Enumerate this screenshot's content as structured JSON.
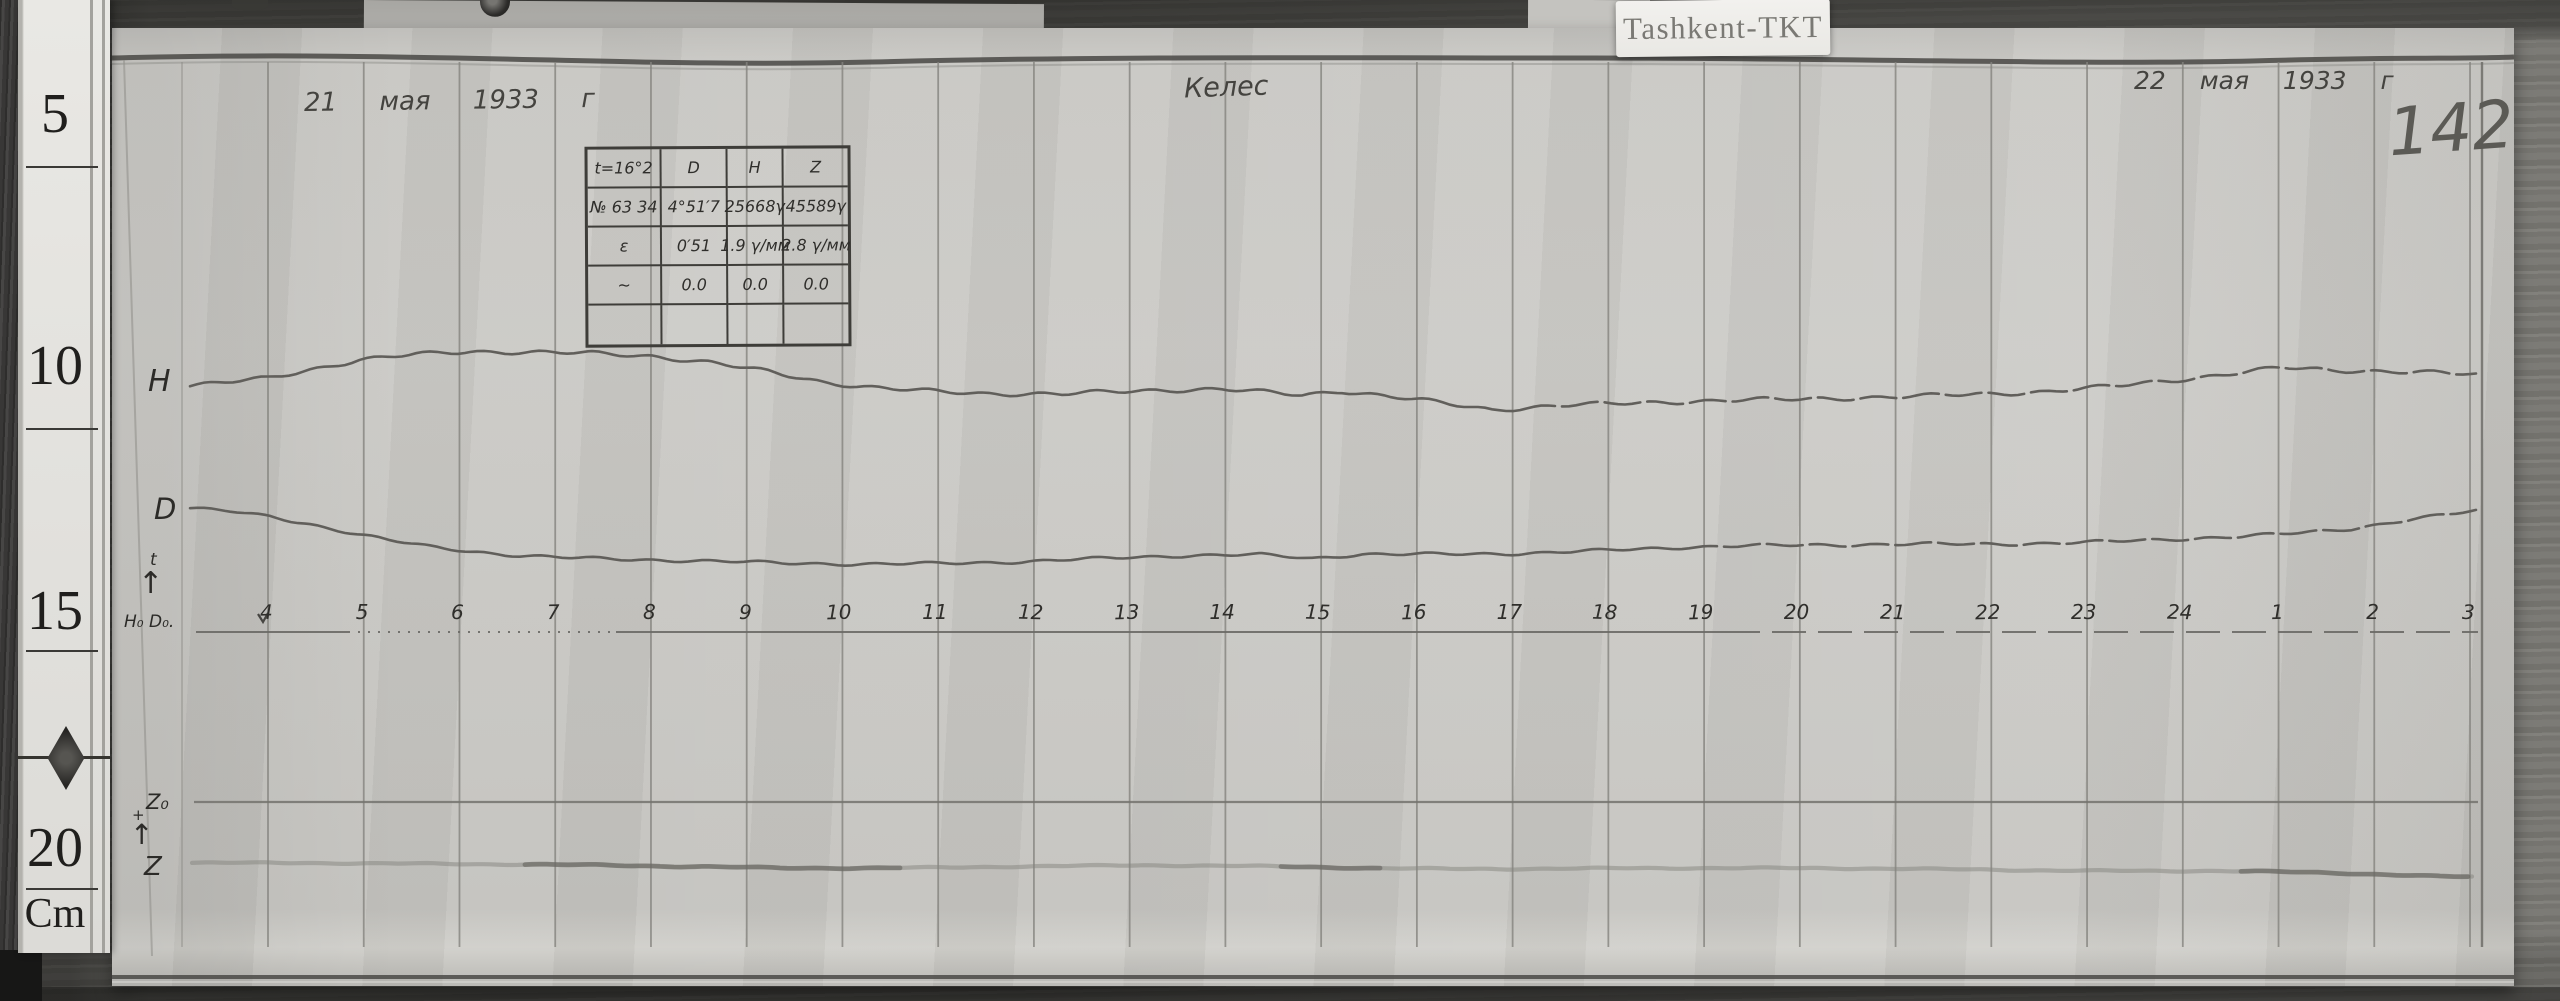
{
  "photo": {
    "label_tag": "Tashkent-TKT",
    "sheet_number": "142",
    "date_left": "21 мая 1933 г",
    "date_right": "22 мая 1933 г",
    "station_name": "Келес"
  },
  "ruler": {
    "marks": [
      "5",
      "10",
      "15",
      "20"
    ],
    "unit": "Cm"
  },
  "annotations": {
    "h_label": "H",
    "d_label": "D",
    "z_label": "Z",
    "z0_label": "Z₀",
    "h0d0_label": "H₀ D₀.",
    "t_label": "t",
    "arrow_up": "↑",
    "plus": "+"
  },
  "scale_table": {
    "rows": [
      [
        "t=16°2",
        "D",
        "H",
        "Z"
      ],
      [
        "№ 63 34",
        "4°51′7",
        "25668γ",
        "45589γ"
      ],
      [
        "ε",
        "0′51",
        "1.9 γ/мм",
        "2.8 γ/мм"
      ],
      [
        "~",
        "0.0",
        "0.0",
        "0.0"
      ],
      [
        "",
        "",
        "",
        ""
      ]
    ]
  },
  "chart_data": {
    "type": "line",
    "title": "Magnetogram, Keles (Tashkent-TKT), 21–22 May 1933, sheet 142",
    "axis_note": "hour lines 4h–24h then 1h–3h; y values are trace positions on the photographic paper in image pixels (down = larger); no printed numeric scale",
    "x_hours": [
      "4",
      "5",
      "6",
      "7",
      "8",
      "9",
      "10",
      "11",
      "12",
      "13",
      "14",
      "15",
      "16",
      "17",
      "18",
      "19",
      "20",
      "21",
      "22",
      "23",
      "24",
      "1",
      "2",
      "3"
    ],
    "scale_values": {
      "D": "0′51 per mm",
      "H": "1.9 γ/мм",
      "Z": "2.8 γ/мм"
    },
    "layout": {
      "x0": 268,
      "dx": 95.74,
      "grid_top": 62,
      "grid_bottom": 947,
      "label_y": 600,
      "left_border_x": 182,
      "right_border_x": 2482
    },
    "baselines": {
      "time_axis": {
        "y": 632,
        "segments": [
          {
            "x1": 196,
            "x2": 348,
            "dash": ""
          },
          {
            "x1": 348,
            "x2": 616,
            "dash": "2 8"
          },
          {
            "x1": 616,
            "x2": 1726,
            "dash": ""
          },
          {
            "x1": 1726,
            "x2": 2478,
            "dash": "34 12"
          }
        ]
      },
      "z0": {
        "y": 802,
        "x1": 194,
        "x2": 2478
      }
    },
    "series": [
      {
        "name": "H",
        "color": "#615f5b",
        "width": 2.6,
        "dash_from": 1560,
        "points_px": [
          [
            190,
            386
          ],
          [
            226,
            382
          ],
          [
            268,
            377
          ],
          [
            310,
            368
          ],
          [
            360,
            358
          ],
          [
            416,
            353
          ],
          [
            470,
            351
          ],
          [
            532,
            353
          ],
          [
            592,
            355
          ],
          [
            652,
            358
          ],
          [
            712,
            364
          ],
          [
            768,
            372
          ],
          [
            822,
            381
          ],
          [
            872,
            386
          ],
          [
            922,
            389
          ],
          [
            982,
            392
          ],
          [
            1062,
            394
          ],
          [
            1142,
            392
          ],
          [
            1222,
            391
          ],
          [
            1302,
            396
          ],
          [
            1342,
            391
          ],
          [
            1422,
            399
          ],
          [
            1492,
            408
          ],
          [
            1562,
            404
          ],
          [
            1642,
            403
          ],
          [
            1722,
            402
          ],
          [
            1802,
            401
          ],
          [
            1882,
            398
          ],
          [
            1962,
            394
          ],
          [
            2042,
            390
          ],
          [
            2122,
            384
          ],
          [
            2202,
            377
          ],
          [
            2282,
            369
          ],
          [
            2332,
            372
          ],
          [
            2392,
            373
          ],
          [
            2442,
            374
          ],
          [
            2476,
            375
          ]
        ]
      },
      {
        "name": "D",
        "color": "#615f5b",
        "width": 2.6,
        "dash_from": 1720,
        "points_px": [
          [
            190,
            508
          ],
          [
            230,
            511
          ],
          [
            270,
            516
          ],
          [
            310,
            523
          ],
          [
            350,
            531
          ],
          [
            390,
            539
          ],
          [
            430,
            546
          ],
          [
            470,
            551
          ],
          [
            520,
            556
          ],
          [
            572,
            559
          ],
          [
            632,
            561
          ],
          [
            702,
            562
          ],
          [
            782,
            563
          ],
          [
            862,
            563
          ],
          [
            942,
            562
          ],
          [
            1022,
            561
          ],
          [
            1102,
            559
          ],
          [
            1182,
            557
          ],
          [
            1262,
            556
          ],
          [
            1312,
            559
          ],
          [
            1362,
            554
          ],
          [
            1442,
            553
          ],
          [
            1522,
            552
          ],
          [
            1602,
            550
          ],
          [
            1682,
            548
          ],
          [
            1762,
            547
          ],
          [
            1842,
            546
          ],
          [
            1922,
            544
          ],
          [
            2002,
            543
          ],
          [
            2082,
            541
          ],
          [
            2162,
            539
          ],
          [
            2242,
            537
          ],
          [
            2302,
            534
          ],
          [
            2352,
            530
          ],
          [
            2402,
            522
          ],
          [
            2442,
            516
          ],
          [
            2476,
            511
          ]
        ]
      },
      {
        "name": "Z",
        "color": "#84837e",
        "width": 4.2,
        "opacity": 0.5,
        "dark_segments": [
          [
            520,
            900
          ],
          [
            1280,
            1380
          ],
          [
            2240,
            2470
          ]
        ],
        "points_px": [
          [
            192,
            863
          ],
          [
            300,
            862
          ],
          [
            420,
            863
          ],
          [
            540,
            865
          ],
          [
            660,
            867
          ],
          [
            780,
            868
          ],
          [
            900,
            867
          ],
          [
            1020,
            866
          ],
          [
            1140,
            866
          ],
          [
            1260,
            867
          ],
          [
            1380,
            868
          ],
          [
            1500,
            868
          ],
          [
            1620,
            868
          ],
          [
            1740,
            869
          ],
          [
            1860,
            869
          ],
          [
            1980,
            869
          ],
          [
            2100,
            870
          ],
          [
            2220,
            871
          ],
          [
            2340,
            874
          ],
          [
            2440,
            877
          ],
          [
            2472,
            877
          ]
        ]
      }
    ]
  }
}
